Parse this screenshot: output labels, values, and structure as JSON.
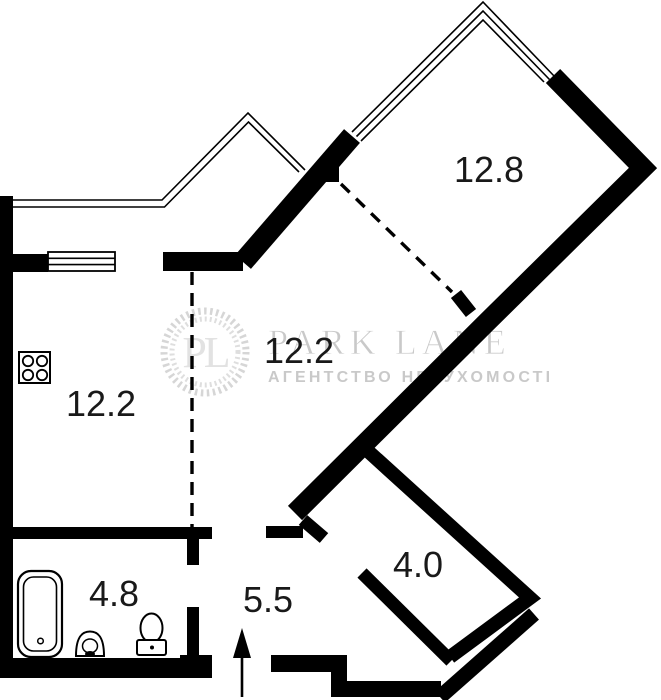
{
  "watermark": {
    "monogram": "PL",
    "brand": "PARK LANE",
    "tagline": "АГЕНТСТВО НЕРУХОМОСТІ"
  },
  "rooms": {
    "bedroom": {
      "label": "12.8"
    },
    "living": {
      "label": "12.2"
    },
    "kitchen": {
      "label": "12.2"
    },
    "bathroom": {
      "label": "4.8"
    },
    "hallway": {
      "label": "5.5"
    },
    "niche": {
      "label": "4.0"
    }
  },
  "icons": {
    "entrance_arrow": "entrance-direction-arrow",
    "stove": "stove-four-burners",
    "bathtub": "bathtub",
    "sink": "wash-basin",
    "toilet": "toilet",
    "wreath": "laurel-wreath"
  },
  "colors": {
    "wall": "#000000",
    "room_label": "#191919",
    "watermark_text": "#c9c9c9",
    "watermark_wreath": "#d6d6d6",
    "background": "#ffffff"
  }
}
